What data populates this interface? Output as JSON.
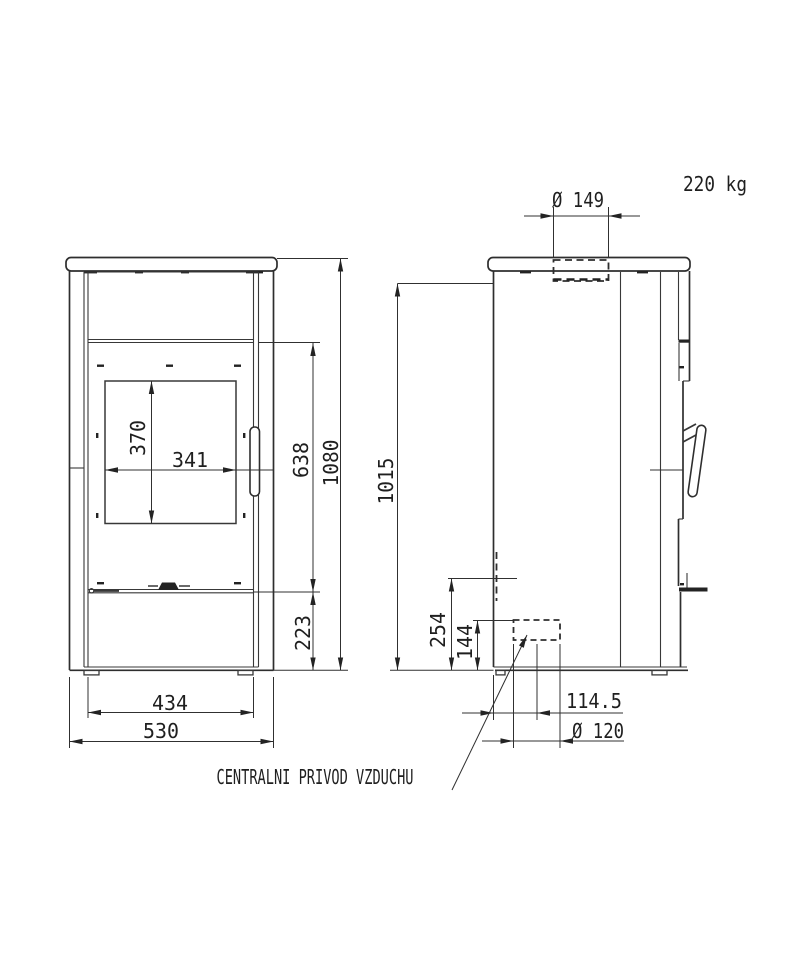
{
  "drawing": {
    "weight": "220 kg",
    "annotation_central_air": "CENTRALNI PRIVOD VZDUCHU",
    "front_view": {
      "overall_height_mm": "1080",
      "firebox_top_height_mm": "638",
      "base_height_mm": "223",
      "glass_height_mm": "370",
      "glass_width_mm": "341",
      "body_width_mm": "434",
      "overall_width_mm": "530"
    },
    "side_view": {
      "flue_diameter": "Ø 149",
      "height_to_top_mm": "1015",
      "air_duct_height_mm": "254",
      "air_inlet_height_mm": "144",
      "air_inlet_offset_mm": "114.5",
      "air_inlet_diameter": "Ø 120"
    }
  }
}
